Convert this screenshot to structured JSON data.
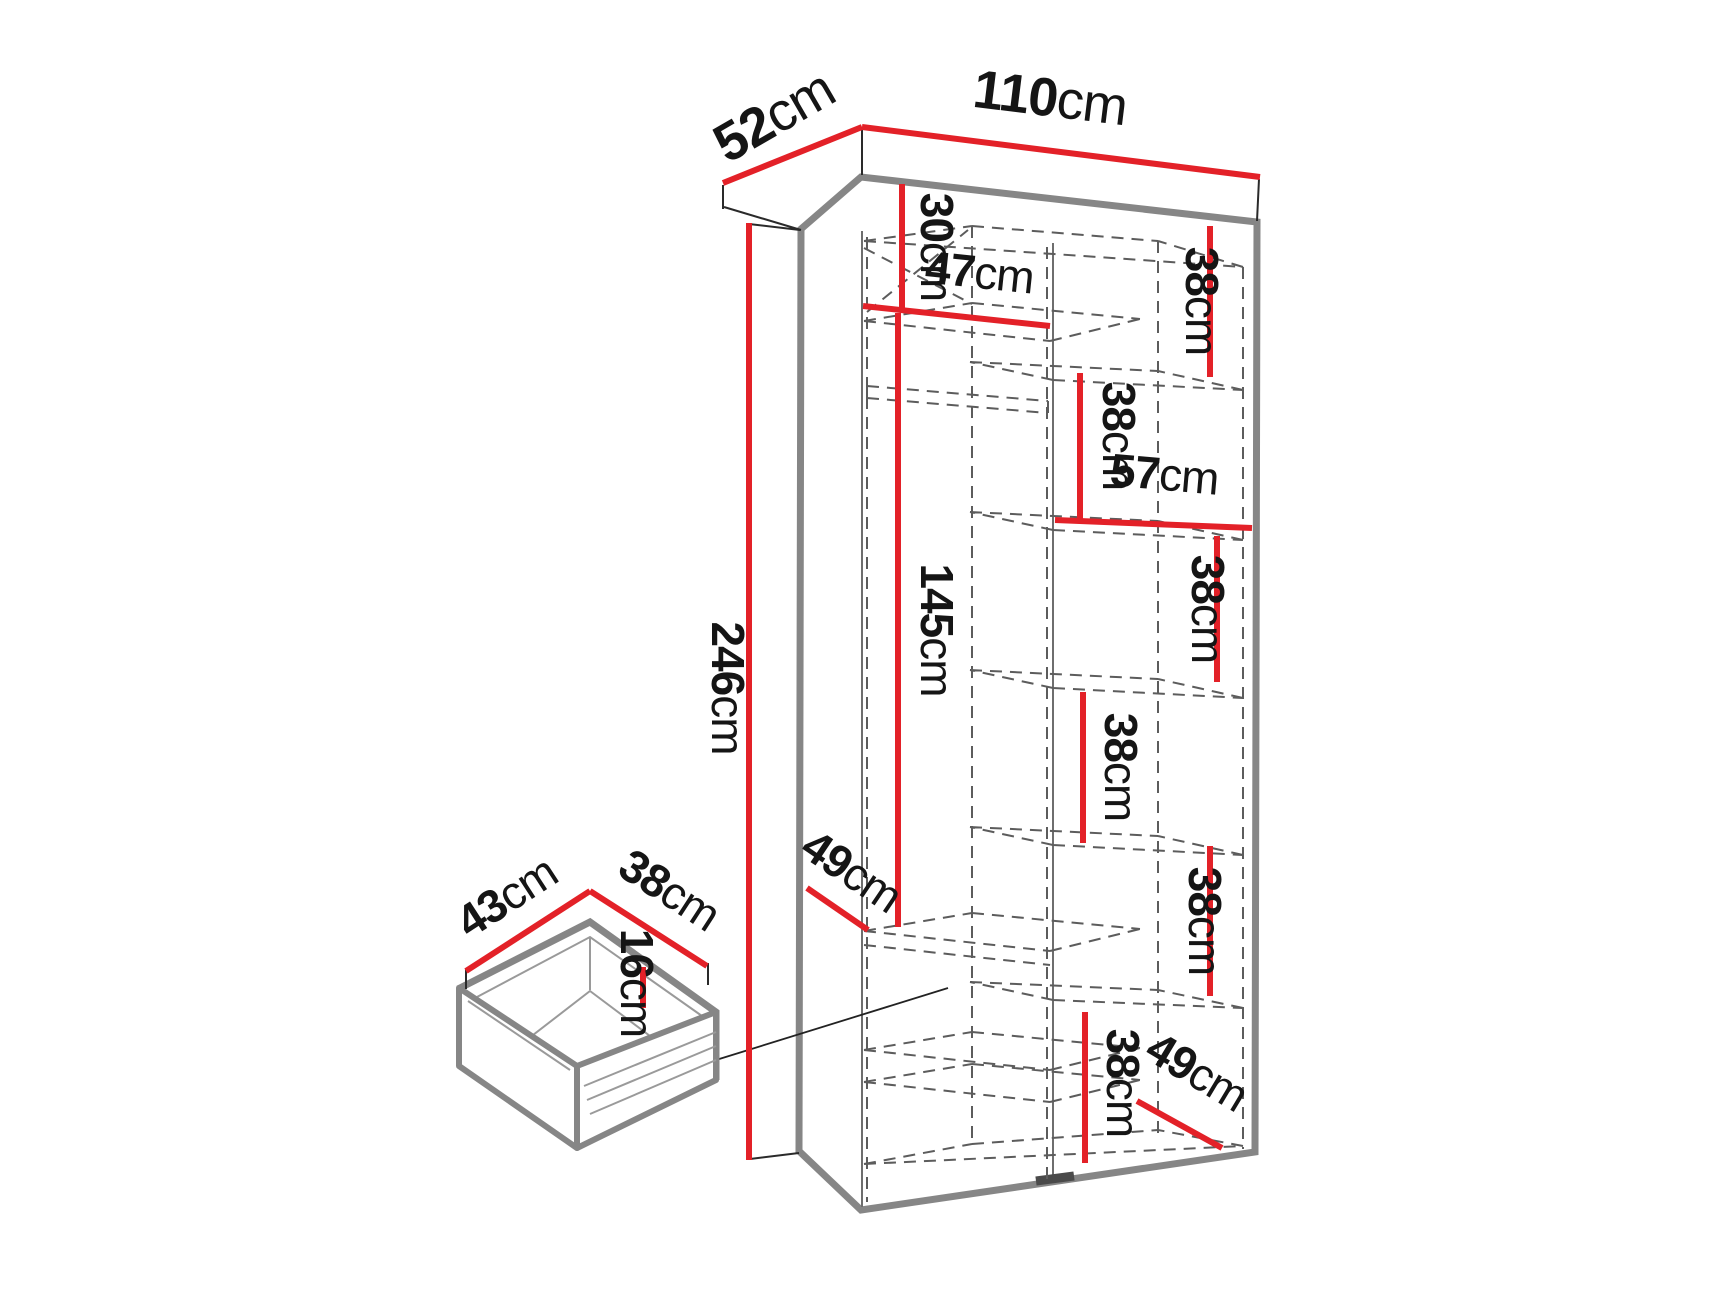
{
  "diagram_title": "wardrobe-dimension-drawing",
  "unit": "cm",
  "colors": {
    "dimension_line": "#e32128",
    "outline": "#868686",
    "hidden_line": "#5c5c5c",
    "label_text": "#151515",
    "background": "#ffffff"
  },
  "wardrobe": {
    "overall": {
      "width": "110cm",
      "depth": "52cm",
      "height": "246cm"
    },
    "interior": {
      "top_section_height": "30cm",
      "top_shelf_width": "47cm",
      "hanging_section_height": "145cm",
      "upper_interior_depth": "49cm",
      "right_shelf_width": "57cm",
      "lower_interior_depth": "49cm",
      "right_sections": [
        "38cm",
        "38cm",
        "38cm",
        "38cm",
        "38cm",
        "38cm"
      ]
    }
  },
  "drawer": {
    "width": "43cm",
    "depth": "38cm",
    "height": "16cm"
  }
}
